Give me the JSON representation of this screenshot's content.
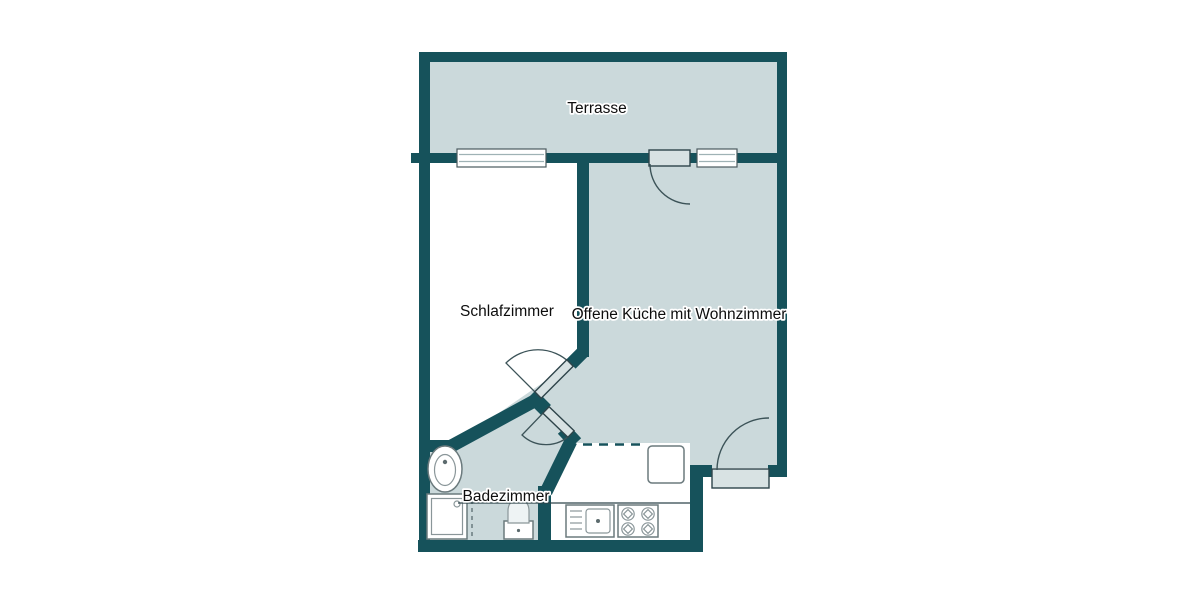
{
  "plan": {
    "title": "Apartment floor plan",
    "colors": {
      "wall": "#16525b",
      "room_fill": "#cbd9db",
      "bedroom_fill": "#ffffff",
      "door_leaf": "#d8e2e3",
      "fixture_border": "#6b7a7d",
      "label_text": "#0d0d0d",
      "background": "#ffffff"
    },
    "rooms": [
      {
        "id": "terrasse",
        "label": "Terrasse"
      },
      {
        "id": "schlafzimmer",
        "label": "Schlafzimmer"
      },
      {
        "id": "wohnkueche",
        "label": "Offene Küche mit Wohnzimmer"
      },
      {
        "id": "badezimmer",
        "label": "Badezimmer"
      }
    ],
    "windows": [
      {
        "name": "bedroom-terrace-window"
      },
      {
        "name": "living-room-terrace-window"
      }
    ],
    "doors": [
      {
        "name": "balcony-door",
        "opens_into": "Offene Küche mit Wohnzimmer"
      },
      {
        "name": "entrance-door",
        "opens_into": "Offene Küche mit Wohnzimmer"
      },
      {
        "name": "bedroom-door",
        "opens_into": "Schlafzimmer"
      },
      {
        "name": "bathroom-door",
        "opens_into": "Badezimmer"
      }
    ],
    "fixtures": [
      {
        "name": "washbasin",
        "room": "Badezimmer"
      },
      {
        "name": "shower",
        "room": "Badezimmer"
      },
      {
        "name": "toilet",
        "room": "Badezimmer"
      },
      {
        "name": "kitchen-sink",
        "room": "Offene Küche mit Wohnzimmer"
      },
      {
        "name": "stove-4-burners",
        "room": "Offene Küche mit Wohnzimmer"
      },
      {
        "name": "kitchen-counter",
        "room": "Offene Küche mit Wohnzimmer"
      }
    ]
  }
}
